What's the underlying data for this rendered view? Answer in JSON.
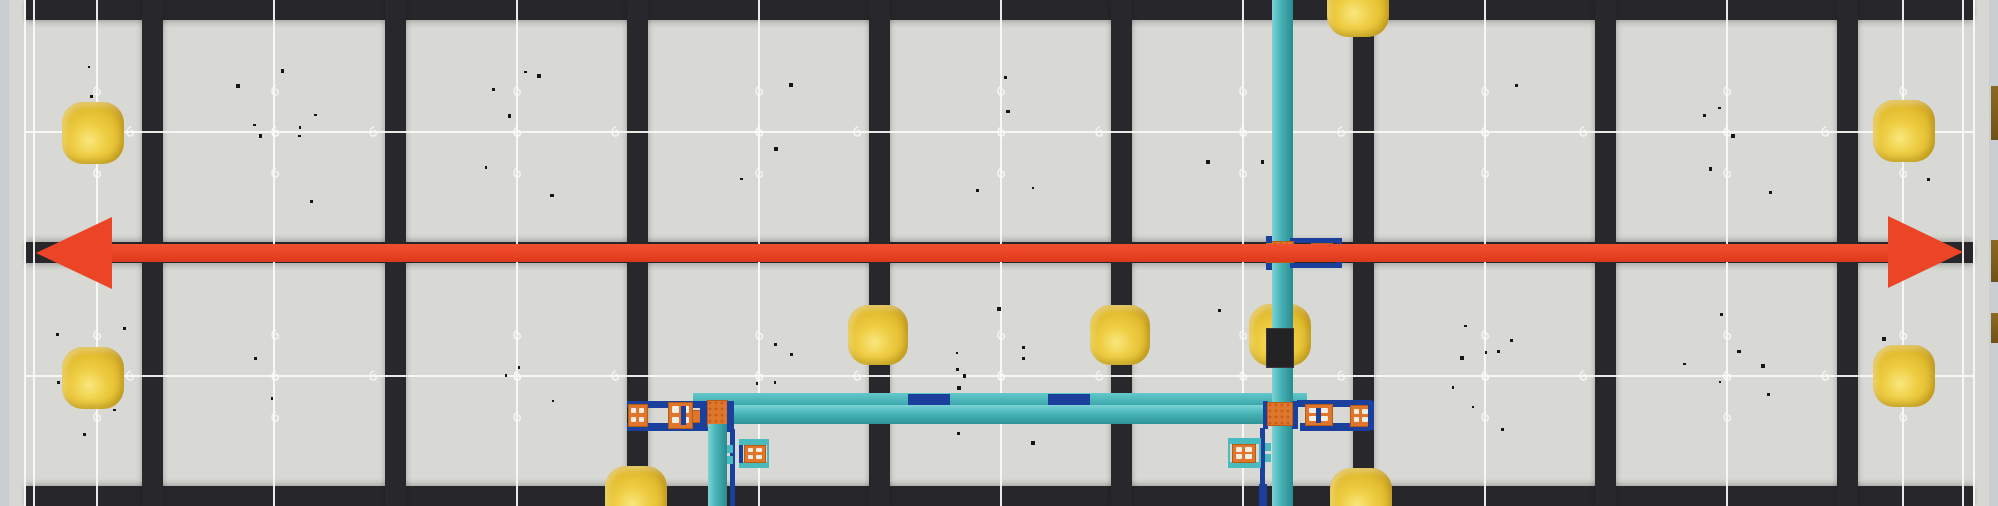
{
  "app": {
    "description": "Top-down rendered view of a robotics competition field: gray foam tiles with dark interlocking seams, yellow balls, a red double-headed arrow spanning the field width, and teal pipe structures with orange couplers and navy brackets"
  },
  "palette": {
    "tile_bg": "#d8d8d4",
    "seam_dark": "#27272b",
    "dot_on_dark": "#c7c7c1",
    "dot_on_tile": "#a1a19b",
    "wall_dash": "#8e8e8a",
    "white_line": "#f6f6f2",
    "red": "#ec4526",
    "teal": "#46b1b5",
    "teal_light": "#54c2c5",
    "navy": "#1b3f9d",
    "orange": "#e0762b",
    "ball_yellow": "#e8c436",
    "black_block": "#232326",
    "wall_outer": "#c9ced2",
    "brown_edge": "#8a6a22"
  },
  "field": {
    "width": 1998,
    "height": 506,
    "walls": {
      "left_outer": [
        0,
        0,
        9,
        506
      ],
      "left_main": [
        9,
        0,
        17,
        506
      ],
      "right_main": [
        1973,
        0,
        16,
        506
      ],
      "right_outer": [
        1989,
        0,
        9,
        506
      ],
      "left_dash_col_x": 10,
      "right_dash_col_x": 1977,
      "edge_dot_cols_x": [
        30,
        1950
      ]
    },
    "bars_y": [
      [
        26,
        0,
        1947,
        20
      ],
      [
        26,
        242,
        1947,
        21
      ],
      [
        26,
        486,
        1947,
        20
      ]
    ],
    "seams_x": [
      152,
      395,
      637,
      879,
      1121,
      1363,
      1605,
      1847
    ],
    "seam_width": 21,
    "vlines_x": [
      24,
      33,
      96,
      273,
      516,
      758,
      1000,
      1242,
      1484,
      1726,
      1902,
      1962,
      1973
    ],
    "hlines_y": [
      131,
      375
    ],
    "tile_centers_x": [
      96,
      273.5,
      516,
      758,
      1000,
      1242,
      1484,
      1726,
      1902
    ],
    "dot_grid": {
      "x0": 65,
      "dx": 39.5,
      "nx": 48,
      "y0": 41,
      "dy": 40.2,
      "ny": 12,
      "top_bar_row_y": 3,
      "cluster": 17,
      "big_cluster": 34
    },
    "curl_rows_y": [
      90,
      131,
      172,
      334,
      375,
      416
    ],
    "speck_seed": 77,
    "speck_count": 90
  },
  "arrow": {
    "shaft": [
      100,
      244,
      1796,
      18
    ],
    "head_left": {
      "tip_x": 36,
      "tip_y": 253,
      "base_x": 112,
      "y_top": 217,
      "y_bot": 289
    },
    "head_right": {
      "tip_x": 1963,
      "tip_y": 252,
      "base_x": 1888,
      "y_top": 216,
      "y_bot": 288
    }
  },
  "balls": [
    {
      "cx": 93,
      "cy": 133,
      "d": 62
    },
    {
      "cx": 93,
      "cy": 378,
      "d": 62
    },
    {
      "cx": 1904,
      "cy": 131,
      "d": 62
    },
    {
      "cx": 1904,
      "cy": 376,
      "d": 62
    },
    {
      "cx": 878,
      "cy": 335,
      "d": 60
    },
    {
      "cx": 1120,
      "cy": 335,
      "d": 60
    },
    {
      "cx": 1280,
      "cy": 335,
      "d": 62
    },
    {
      "cx": 1358,
      "cy": 6,
      "d": 62
    },
    {
      "cx": 636,
      "cy": 497,
      "d": 62
    },
    {
      "cx": 1361,
      "cy": 499,
      "d": 62
    }
  ],
  "structures": {
    "mid": [
      {
        "c": "flange",
        "r": [
          693,
          393,
          614,
          12
        ]
      },
      {
        "c": "navy",
        "r": [
          908,
          394,
          42,
          12
        ]
      },
      {
        "c": "navy",
        "r": [
          1048,
          394,
          42,
          12
        ]
      },
      {
        "c": "beam",
        "r": [
          727,
          405,
          541,
          19
        ]
      },
      {
        "c": "navy",
        "r": [
          627,
          401,
          78,
          7
        ]
      },
      {
        "c": "navy",
        "r": [
          627,
          423,
          78,
          8
        ]
      },
      {
        "c": "orangeb",
        "r": [
          628,
          404,
          20,
          23
        ],
        "holes": true
      },
      {
        "c": "orangeb",
        "r": [
          668,
          402,
          25,
          27
        ],
        "holes": true
      },
      {
        "c": "navy",
        "r": [
          681,
          406,
          5,
          19
        ]
      },
      {
        "c": "orangeb",
        "r": [
          692,
          410,
          11,
          13
        ]
      },
      {
        "c": "navy",
        "r": [
          700,
          401,
          8,
          30
        ]
      },
      {
        "c": "coupler",
        "r": [
          707,
          400,
          21,
          27
        ]
      },
      {
        "c": "navy",
        "r": [
          727,
          401,
          7,
          31
        ]
      },
      {
        "c": "pipev",
        "r": [
          708,
          424,
          19,
          82
        ]
      },
      {
        "c": "navy",
        "r": [
          730,
          429,
          5,
          77
        ]
      },
      {
        "c": "tealtab",
        "r": [
          727,
          445,
          6,
          8
        ]
      },
      {
        "c": "tealtab",
        "r": [
          727,
          456,
          6,
          8
        ]
      },
      {
        "c": "tealframe",
        "r": [
          739,
          439,
          30,
          29
        ]
      },
      {
        "c": "navy",
        "r": [
          739,
          445,
          4,
          18
        ]
      },
      {
        "c": "orangeb",
        "r": [
          744,
          445,
          22,
          18
        ],
        "holes": true
      },
      {
        "c": "navy",
        "r": [
          1260,
          428,
          5,
          76
        ]
      },
      {
        "c": "navy",
        "r": [
          1259,
          484,
          8,
          22
        ]
      },
      {
        "c": "tealframe",
        "r": [
          1228,
          438,
          33,
          30
        ]
      },
      {
        "c": "orangeb",
        "r": [
          1232,
          444,
          24,
          19
        ],
        "holes": true
      },
      {
        "c": "tealtab",
        "r": [
          1265,
          443,
          6,
          8
        ]
      },
      {
        "c": "tealtab",
        "r": [
          1265,
          454,
          6,
          8
        ]
      },
      {
        "c": "navy",
        "r": [
          1297,
          400,
          75,
          7
        ]
      },
      {
        "c": "navy",
        "r": [
          1300,
          423,
          70,
          8
        ]
      },
      {
        "c": "orangeb",
        "r": [
          1305,
          404,
          28,
          22
        ],
        "holes": true
      },
      {
        "c": "navy",
        "r": [
          1316,
          408,
          5,
          15
        ]
      },
      {
        "c": "orangeb",
        "r": [
          1350,
          405,
          22,
          22
        ],
        "holes": true
      },
      {
        "c": "navy",
        "r": [
          1368,
          401,
          6,
          29
        ]
      }
    ],
    "pipe_main": {
      "c": "pipev",
      "r": [
        1272,
        0,
        21,
        506
      ]
    },
    "over_pipe": [
      {
        "c": "blackblock",
        "r": [
          1266,
          328,
          28,
          40
        ]
      },
      {
        "c": "navy",
        "r": [
          1263,
          401,
          5,
          28
        ]
      },
      {
        "c": "navy",
        "r": [
          1292,
          401,
          6,
          28
        ]
      },
      {
        "c": "coupler",
        "r": [
          1267,
          402,
          26,
          24
        ]
      },
      {
        "c": "navybracket",
        "r": [
          1290,
          238,
          52,
          30
        ]
      },
      {
        "c": "coupler",
        "r": [
          1311,
          243,
          22,
          17
        ]
      },
      {
        "c": "coupler",
        "r": [
          1266,
          241,
          28,
          22
        ]
      },
      {
        "c": "navy",
        "r": [
          1266,
          236,
          6,
          7
        ]
      },
      {
        "c": "navy",
        "r": [
          1266,
          263,
          6,
          7
        ]
      }
    ],
    "edge_slivers": [
      {
        "c": "brown1",
        "r": [
          1991,
          86,
          7,
          54
        ]
      },
      {
        "c": "brown1",
        "r": [
          1991,
          240,
          7,
          42
        ]
      },
      {
        "c": "brown1",
        "r": [
          1991,
          313,
          7,
          30
        ]
      }
    ]
  }
}
